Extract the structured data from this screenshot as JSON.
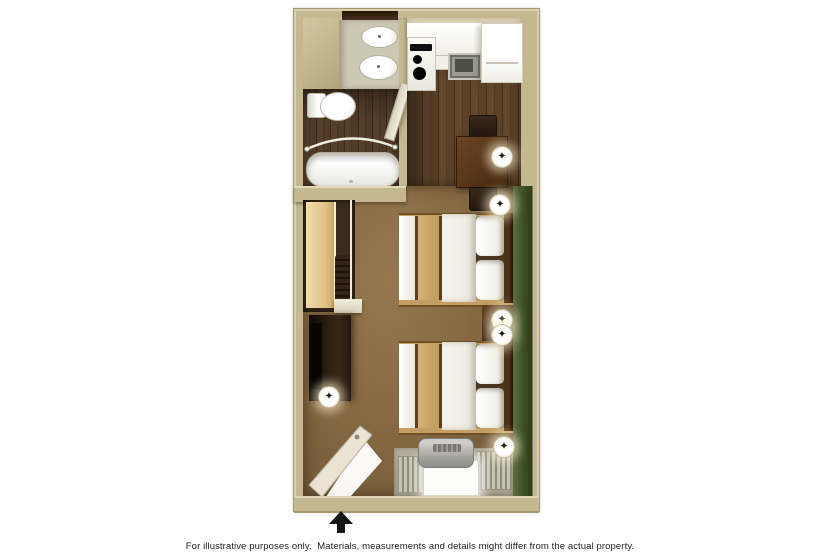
{
  "footnote": "For illustrative purposes only.  Materials, measurements and details might differ from the actual property.",
  "icons": {
    "ceiling_light_glyph": "✦"
  },
  "palette": {
    "page_bg": "#ffffff",
    "wall": "#c3b88f",
    "wall_light": "#d9cfae",
    "wall_edge": "#a59a72",
    "bath_wall": "#d9d1b8",
    "vanity": "#cdc8b4",
    "bath_floor": "#503a28",
    "kitchen_floor": "#5b4128",
    "carpet": "#876a43",
    "green_wall": "#3e4f24",
    "counter_white": "#f6f5f0",
    "appliance_black": "#101010",
    "steel_sink": "#9b9b93",
    "table_wood": "#5e3c20",
    "chair_wood": "#2c1d11",
    "bed_white": "#f4f2ec",
    "bed_tan": "#d6b177",
    "bed_skirt": "#c49e63",
    "headboard": "#4c3018",
    "nightstand": "#40260f",
    "dresser": "#1c130b",
    "closet_shelf": "#e4c78b",
    "clothes_dark": "#2a1c10",
    "ptac_gray": "#a8a7a2",
    "blinds_gray": "#b3ae9e",
    "door_cream": "#eae3d1",
    "arrow": "#141414",
    "text": "#1f1f1f"
  },
  "floorplan": {
    "view": "top-down 3D studio suite floor plan",
    "entrance": {
      "arrow_direction": "up"
    },
    "rooms": [
      "bathroom",
      "kitchen",
      "dining-area",
      "bedroom-living-area",
      "closet",
      "entry"
    ],
    "furniture": [
      "vanity-with-sink",
      "mirror",
      "toilet",
      "bathtub-with-curved-shower-rod",
      "bathroom-door",
      "stove-cooktop",
      "kitchen-sink",
      "refrigerator",
      "kitchen-cabinets",
      "dining-table",
      "dining-chair",
      "dining-chair",
      "closet-shelf",
      "hanging-clothes",
      "closet-rod",
      "dresser-with-tv",
      "double-bed",
      "double-bed",
      "nightstand",
      "green-accent-wall",
      "window",
      "window-blinds",
      "ptac-air-conditioner",
      "entry-door"
    ],
    "ceiling_lights_count": 6
  }
}
